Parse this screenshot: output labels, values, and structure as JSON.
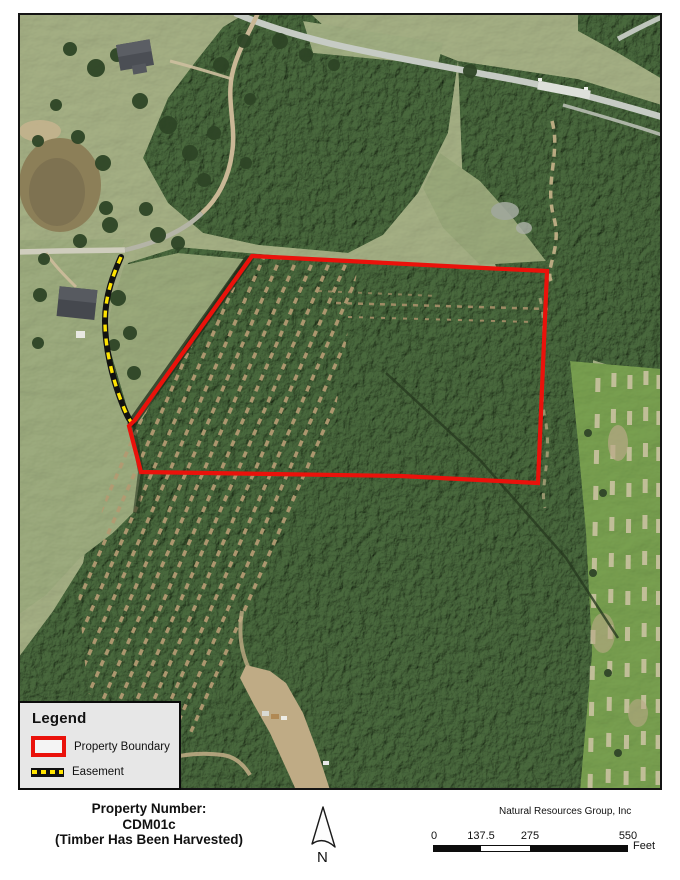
{
  "legend": {
    "title": "Legend",
    "items": [
      {
        "label": "Property Boundary",
        "symbol": "red-rectangle-outline",
        "color": "#ea120b"
      },
      {
        "label": "Easement",
        "symbol": "yellow-black-dashed-line",
        "line_color": "#111111",
        "dash_color": "#ffe400"
      }
    ]
  },
  "map": {
    "kind": "aerial-photo",
    "boundary_color": "#ea120b",
    "easement_line_color": "#111111",
    "easement_dash_color": "#ffe400"
  },
  "footer": {
    "property_label": "Property Number:",
    "property_number": "CDM01c",
    "property_note": "(Timber Has Been Harvested)",
    "company": "Natural Resources Group, Inc",
    "north_label": "N",
    "scale_bar": {
      "tick_labels": [
        "0",
        "137.5",
        "275",
        "550"
      ],
      "unit": "Feet"
    }
  }
}
